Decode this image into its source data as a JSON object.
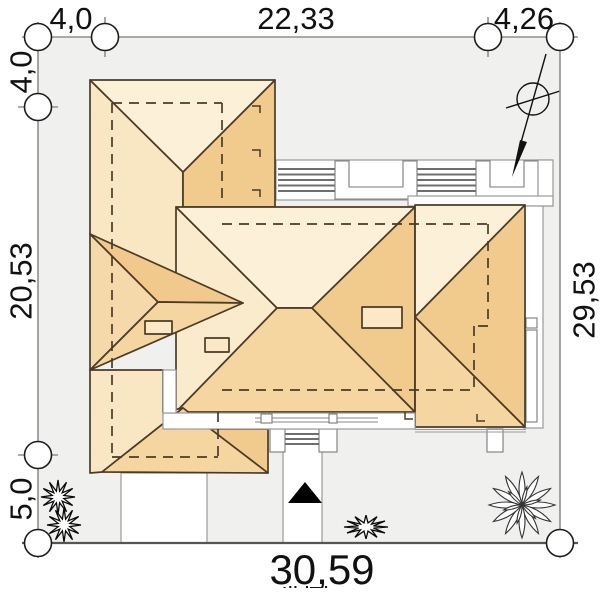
{
  "drawing": {
    "type": "house-site-plan-roof-view",
    "bottom_clipped": "Ill lTl"
  },
  "dimensions": {
    "top_left": "4,0",
    "top_center": "22,33",
    "top_right": "4,26",
    "left_top": "4,0",
    "left_middle": "20,53",
    "left_bottom": "5,0",
    "right_side": "29,53",
    "bottom": "30,59"
  },
  "colors": {
    "site_fill": "#f0f0ee",
    "roof_north": "#fcf1d8",
    "roof_west": "#f9e6c2",
    "roof_main_west": "#faebcd",
    "roof_south": "#f5d5a0",
    "roof_east": "#f1ca8e",
    "roof_east_dark": "#f1c98d",
    "roof_hip_west": "#f6d9aa",
    "chimney_fill": "#fbe8c6",
    "roof_line": "#4b3b26",
    "entrance_marker": "#000000"
  },
  "icons": {
    "north_arrow": "north-arrow-compass",
    "entrance": "entrance-triangle",
    "plants": [
      "spiky-bush",
      "spiky-bush",
      "grass-tuft",
      "leafy-bush"
    ]
  }
}
